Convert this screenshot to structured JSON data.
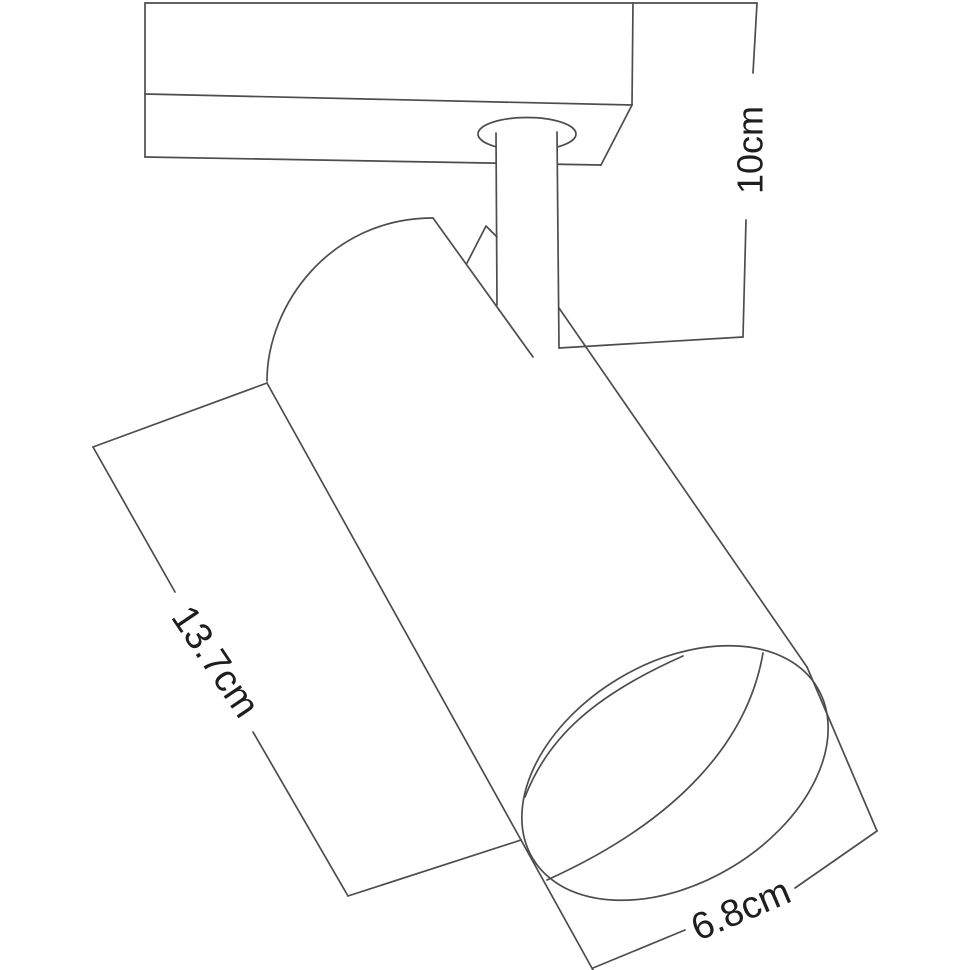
{
  "diagram": {
    "type": "product-dimension-drawing",
    "subject": "ceiling-track-spotlight",
    "labels": {
      "height": "10cm",
      "body_length": "13.7cm",
      "head_diameter": "6.8cm"
    },
    "colors": {
      "background": "#ffffff",
      "line": "#4d4d4d",
      "text": "#1e1e1e"
    }
  }
}
